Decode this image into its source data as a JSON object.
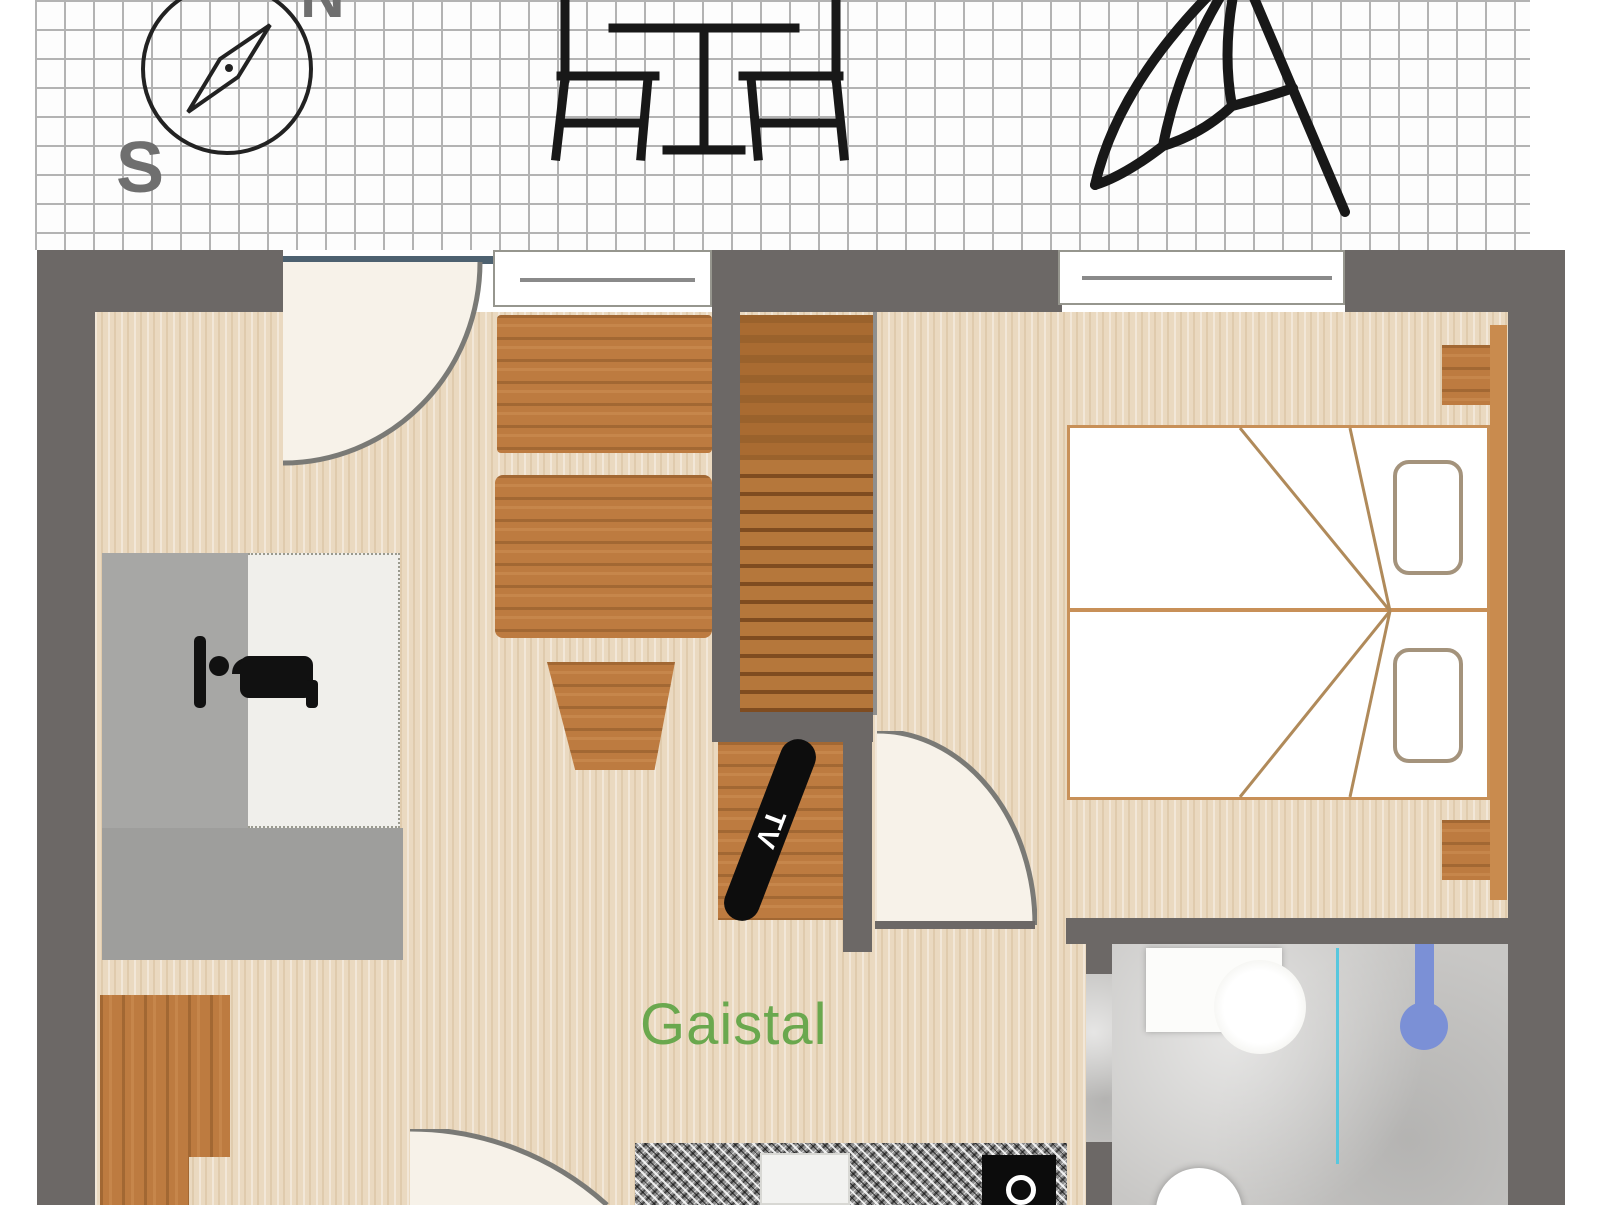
{
  "title": "Apartment floor plan",
  "terrace": {
    "compass": {
      "north_label": "N",
      "south_label": "S"
    },
    "icons": [
      "compass",
      "bistro-table-with-two-chairs",
      "parasol"
    ]
  },
  "plan": {
    "room_label": "Gaistal",
    "tv_label": "TV"
  },
  "palette": {
    "wall_gray": "#6c6866",
    "floor_wood": "#ead9c0",
    "furniture_wood": "#bd7b40",
    "stair_tread_dark": "#7f4c20",
    "bathroom_floor": "#c8c7c5",
    "label_green": "#6aa84e",
    "shower_blue": "#7b90d6",
    "glass_blue": "#57c7de",
    "bed_frame_tan": "#c89058",
    "sofa_gray": "#a7a7a5",
    "door_leaf_slate": "#4d6170",
    "grid_line": "#b0b0b0"
  }
}
